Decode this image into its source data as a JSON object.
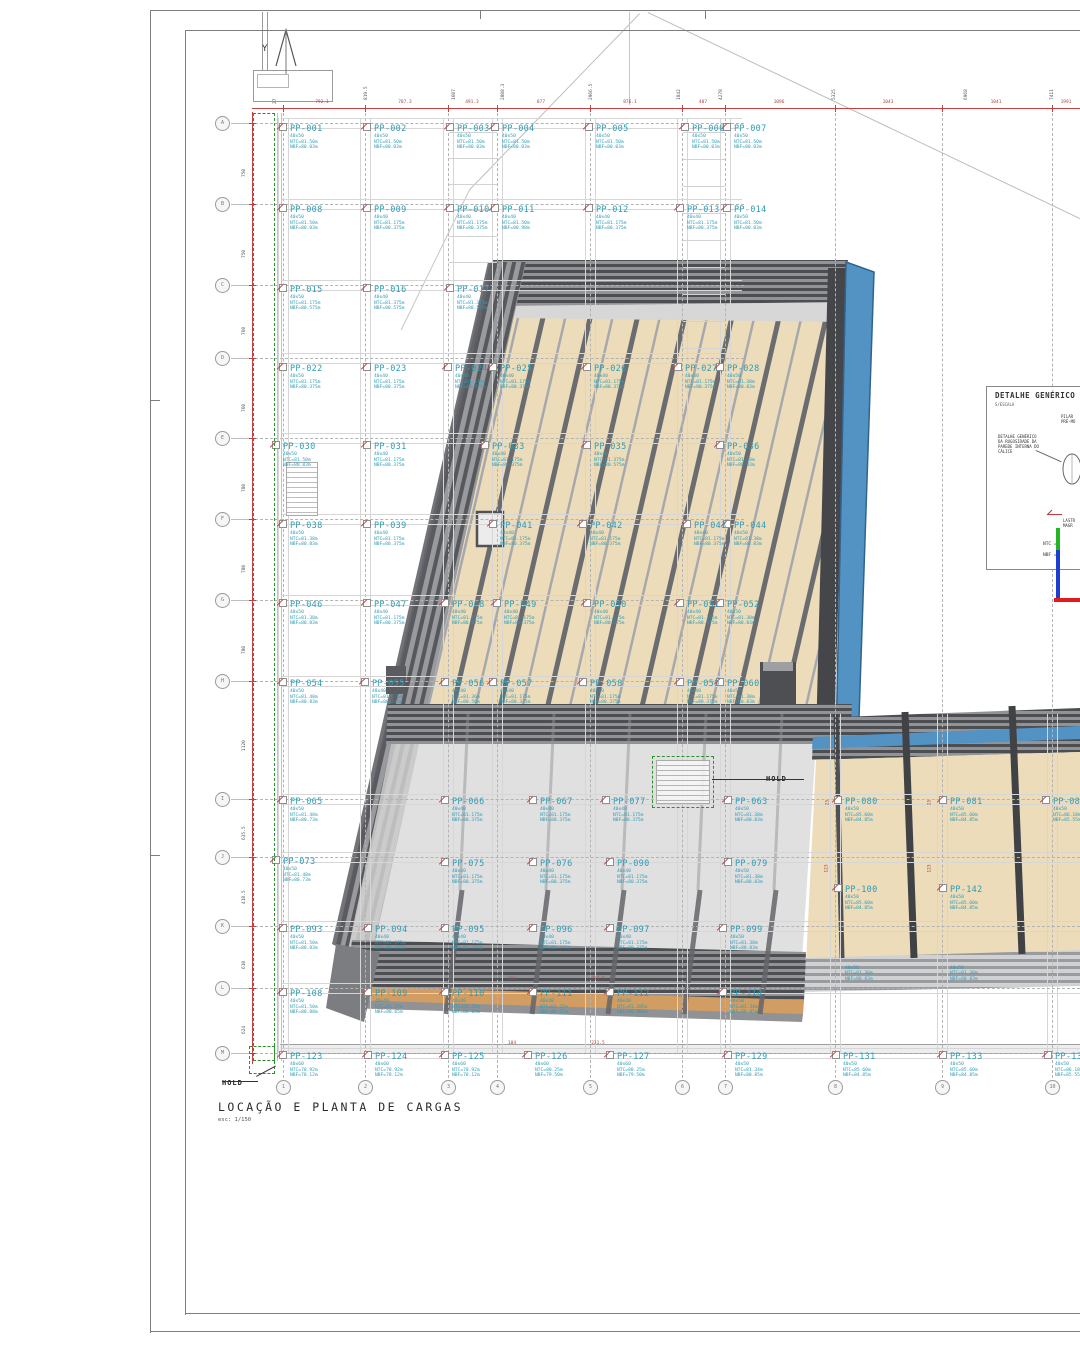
{
  "sheet": {
    "north_label": "Y",
    "title": "LOCAÇÃO E PLANTA DE CARGAS",
    "scale_note": "esc: 1/150",
    "hold_label": "HOLD"
  },
  "detail_box": {
    "title": "DETALHE GENÉRICO",
    "scale": "S/ESCALA",
    "pilar_label": "PILAR\nPRÉ-MO",
    "rugosidade_label": "DETALHE GENÉRICO\nDA RUGOSIDADE DA\nPAREDE INTERNA DO\nCÁLICE",
    "lastro_label": "LASTR\nMAGR",
    "ntc_label": "NTC =",
    "nbf_label": "NBF ="
  },
  "colors": {
    "pile_label": "#2e9bb5",
    "dimension_red": "#c24040",
    "hold_green": "#2f8f2f",
    "blue_cladding": "#4b8fc2",
    "floor_beige": "#ecdbb8",
    "wood_band": "#d09a5c"
  },
  "grid": {
    "rows": [
      {
        "label": "A",
        "y": 123
      },
      {
        "label": "B",
        "y": 204
      },
      {
        "label": "C",
        "y": 285
      },
      {
        "label": "D",
        "y": 358
      },
      {
        "label": "E",
        "y": 438
      },
      {
        "label": "F",
        "y": 519
      },
      {
        "label": "G",
        "y": 600
      },
      {
        "label": "H",
        "y": 681
      },
      {
        "label": "I",
        "y": 799
      },
      {
        "label": "J",
        "y": 857
      },
      {
        "label": "K",
        "y": 926
      },
      {
        "label": "L",
        "y": 988
      },
      {
        "label": "M",
        "y": 1053
      }
    ],
    "cols": [
      {
        "label": "1",
        "x": 283
      },
      {
        "label": "2",
        "x": 365
      },
      {
        "label": "3",
        "x": 448
      },
      {
        "label": "4",
        "x": 497
      },
      {
        "label": "5",
        "x": 590
      },
      {
        "label": "6",
        "x": 682
      },
      {
        "label": "7",
        "x": 725
      },
      {
        "label": "8",
        "x": 835
      },
      {
        "label": "9",
        "x": 942
      },
      {
        "label": "10",
        "x": 1052
      }
    ]
  },
  "dims": {
    "top_values": [
      {
        "t": "792.1",
        "x": 322
      },
      {
        "t": "787.3",
        "x": 405
      },
      {
        "t": "491.3",
        "x": 472
      },
      {
        "t": "877",
        "x": 541
      },
      {
        "t": "876.1",
        "x": 630
      },
      {
        "t": "407",
        "x": 703
      },
      {
        "t": "1096",
        "x": 779
      },
      {
        "t": "1043",
        "x": 888
      },
      {
        "t": "1041",
        "x": 996
      },
      {
        "t": "1991",
        "x": 1066
      }
    ],
    "top_rotated": [
      {
        "t": "819.5",
        "x": 367
      },
      {
        "t": "1607",
        "x": 455
      },
      {
        "t": "2808.3",
        "x": 504
      },
      {
        "t": "2966.5",
        "x": 592
      },
      {
        "t": "1842",
        "x": 680
      },
      {
        "t": "4278",
        "x": 722
      },
      {
        "t": "5325",
        "x": 835
      },
      {
        "t": "6968",
        "x": 967
      },
      {
        "t": "7411",
        "x": 1053
      }
    ],
    "left_rotated": [
      {
        "t": "750",
        "y": 163
      },
      {
        "t": "750",
        "y": 244
      },
      {
        "t": "760",
        "y": 321
      },
      {
        "t": "760",
        "y": 398
      },
      {
        "t": "780",
        "y": 478
      },
      {
        "t": "780",
        "y": 559
      },
      {
        "t": "780",
        "y": 640
      },
      {
        "t": "1120",
        "y": 737
      },
      {
        "t": "635.5",
        "y": 826
      },
      {
        "t": "418.5",
        "y": 890
      },
      {
        "t": "610",
        "y": 955
      },
      {
        "t": "624",
        "y": 1020
      }
    ],
    "inner": [
      {
        "t": "104",
        "x": 512,
        "y": 977
      },
      {
        "t": "231.5",
        "x": 598,
        "y": 977
      },
      {
        "t": "104",
        "x": 512,
        "y": 1041
      },
      {
        "t": "231.5",
        "x": 598,
        "y": 1041
      },
      {
        "t": "25",
        "x": 828,
        "y": 800,
        "rot": true
      },
      {
        "t": "123",
        "x": 827,
        "y": 866,
        "rot": true
      },
      {
        "t": "25",
        "x": 930,
        "y": 800,
        "rot": true
      },
      {
        "t": "123",
        "x": 930,
        "y": 866,
        "rot": true
      }
    ],
    "misc_rotated": [
      {
        "t": "27",
        "x": 273,
        "y": 80
      }
    ]
  },
  "piles": [
    {
      "id": "PP-001",
      "x": 290,
      "y": 125,
      "s": [
        "40x50",
        "NTC=81.50m",
        "NBF=80.03m"
      ]
    },
    {
      "id": "PP-002",
      "x": 374,
      "y": 125,
      "s": [
        "40x50",
        "NTC=81.50m",
        "NBF=80.03m"
      ]
    },
    {
      "id": "PP-003",
      "x": 457,
      "y": 125,
      "s": [
        "40x50",
        "NTC=81.50m",
        "NBF=80.03m"
      ]
    },
    {
      "id": "PP-004",
      "x": 502,
      "y": 125,
      "s": [
        "40x50",
        "NTC=81.50m",
        "NBF=80.03m"
      ]
    },
    {
      "id": "PP-005",
      "x": 596,
      "y": 125,
      "s": [
        "40x50",
        "NTC=81.50m",
        "NBF=80.03m"
      ]
    },
    {
      "id": "PP-006",
      "x": 692,
      "y": 125,
      "s": [
        "40x50",
        "NTC=81.50m",
        "NBF=80.03m"
      ]
    },
    {
      "id": "PP-007",
      "x": 734,
      "y": 125,
      "s": [
        "40x50",
        "NTC=81.50m",
        "NBF=80.03m"
      ]
    },
    {
      "id": "PP-008",
      "x": 290,
      "y": 206,
      "s": [
        "40x50",
        "NTC=81.50m",
        "NBF=80.03m"
      ]
    },
    {
      "id": "PP-009",
      "x": 374,
      "y": 206,
      "s": [
        "40x40",
        "NTC=81.175m",
        "NBF=80.375m"
      ]
    },
    {
      "id": "PP-010",
      "x": 457,
      "y": 206,
      "s": [
        "40x40",
        "NTC=81.175m",
        "NBF=80.375m"
      ]
    },
    {
      "id": "PP-011",
      "x": 502,
      "y": 206,
      "s": [
        "40x40",
        "NTC=81.50m",
        "NBF=80.98m"
      ]
    },
    {
      "id": "PP-012",
      "x": 596,
      "y": 206,
      "s": [
        "40x40",
        "NTC=81.175m",
        "NBF=80.375m"
      ]
    },
    {
      "id": "PP-013",
      "x": 687,
      "y": 206,
      "s": [
        "40x40",
        "NTC=81.175m",
        "NBF=80.375m"
      ]
    },
    {
      "id": "PP-014",
      "x": 734,
      "y": 206,
      "s": [
        "40x50",
        "NTC=81.50m",
        "NBF=80.03m"
      ]
    },
    {
      "id": "PP-015",
      "x": 290,
      "y": 286,
      "s": [
        "40x50",
        "NTC=81.175m",
        "NBF=80.575m"
      ]
    },
    {
      "id": "PP-016",
      "x": 374,
      "y": 286,
      "s": [
        "40x40",
        "NTC=81.375m",
        "NBF=80.575m"
      ]
    },
    {
      "id": "PP-017",
      "x": 457,
      "y": 286,
      "s": [
        "40x40",
        "NTC=81.375m",
        "NBF=80.575m"
      ]
    },
    {
      "id": "PP-022",
      "x": 290,
      "y": 365,
      "s": [
        "40x50",
        "NTC=81.175m",
        "NBF=80.375m"
      ]
    },
    {
      "id": "PP-023",
      "x": 374,
      "y": 365,
      "s": [
        "40x40",
        "NTC=81.175m",
        "NBF=80.375m"
      ]
    },
    {
      "id": "PP-024",
      "x": 455,
      "y": 365,
      "s": [
        "40x40",
        "NTC=81.175m",
        "NBF=80.375m"
      ]
    },
    {
      "id": "PP-025",
      "x": 500,
      "y": 365,
      "s": [
        "40x40",
        "NTC=81.175m",
        "NBF=80.375m"
      ]
    },
    {
      "id": "PP-026",
      "x": 594,
      "y": 365,
      "s": [
        "40x40",
        "NTC=81.175m",
        "NBF=80.375m"
      ]
    },
    {
      "id": "PP-027",
      "x": 685,
      "y": 365,
      "s": [
        "40x40",
        "NTC=81.175m",
        "NBF=80.375m"
      ]
    },
    {
      "id": "PP-028",
      "x": 727,
      "y": 365,
      "s": [
        "40x50",
        "NTC=81.38m",
        "NBF=80.83m"
      ]
    },
    {
      "id": "PP-030",
      "x": 283,
      "y": 443,
      "s": [
        "40x50",
        "NTC=81.50m",
        "NBF=80.83m"
      ]
    },
    {
      "id": "PP-031",
      "x": 374,
      "y": 443,
      "s": [
        "40x40",
        "NTC=81.175m",
        "NBF=80.375m"
      ]
    },
    {
      "id": "PP-033",
      "x": 492,
      "y": 443,
      "s": [
        "40x40",
        "NTC=81.175m",
        "NBF=80.375m"
      ]
    },
    {
      "id": "PP-035",
      "x": 594,
      "y": 443,
      "s": [
        "40x40",
        "NTC=81.375m",
        "NBF=80.575m"
      ]
    },
    {
      "id": "PP-036",
      "x": 727,
      "y": 443,
      "s": [
        "40x50",
        "NTC=81.38m",
        "NBF=80.83m"
      ]
    },
    {
      "id": "PP-038",
      "x": 290,
      "y": 522,
      "s": [
        "40x50",
        "NTC=81.38m",
        "NBF=80.83m"
      ]
    },
    {
      "id": "PP-039",
      "x": 374,
      "y": 522,
      "s": [
        "40x40",
        "NTC=81.175m",
        "NBF=80.375m"
      ]
    },
    {
      "id": "PP-041",
      "x": 500,
      "y": 522,
      "s": [
        "40x40",
        "NTC=81.175m",
        "NBF=80.375m"
      ]
    },
    {
      "id": "PP-042",
      "x": 590,
      "y": 522,
      "s": [
        "40x40",
        "NTC=81.175m",
        "NBF=80.375m"
      ]
    },
    {
      "id": "PP-043",
      "x": 694,
      "y": 522,
      "s": [
        "40x40",
        "NTC=81.175m",
        "NBF=80.375m"
      ]
    },
    {
      "id": "PP-044",
      "x": 734,
      "y": 522,
      "s": [
        "40x50",
        "NTC=81.38m",
        "NBF=80.83m"
      ]
    },
    {
      "id": "PP-046",
      "x": 290,
      "y": 601,
      "s": [
        "40x50",
        "NTC=81.38m",
        "NBF=80.83m"
      ]
    },
    {
      "id": "PP-047",
      "x": 374,
      "y": 601,
      "s": [
        "40x40",
        "NTC=81.175m",
        "NBF=80.375m"
      ]
    },
    {
      "id": "PP-048",
      "x": 452,
      "y": 601,
      "s": [
        "40x40",
        "NTC=81.175m",
        "NBF=80.375m"
      ]
    },
    {
      "id": "PP-049",
      "x": 504,
      "y": 601,
      "s": [
        "40x40",
        "NTC=81.175m",
        "NBF=80.375m"
      ]
    },
    {
      "id": "PP-050",
      "x": 594,
      "y": 601,
      "s": [
        "40x40",
        "NTC=81.175m",
        "NBF=80.375m"
      ]
    },
    {
      "id": "PP-051",
      "x": 687,
      "y": 601,
      "s": [
        "40x40",
        "NTC=81.175m",
        "NBF=80.375m"
      ]
    },
    {
      "id": "PP-052",
      "x": 727,
      "y": 601,
      "s": [
        "40x50",
        "NTC=81.38m",
        "NBF=80.83m"
      ]
    },
    {
      "id": "PP-054",
      "x": 290,
      "y": 680,
      "s": [
        "40x50",
        "NTC=81.40m",
        "NBF=80.83m"
      ]
    },
    {
      "id": "PP-055",
      "x": 372,
      "y": 680,
      "s": [
        "40x40",
        "NTC=81.175m",
        "NBF=80.375m"
      ]
    },
    {
      "id": "PP-056",
      "x": 452,
      "y": 680,
      "s": [
        "40x40",
        "NTC=81.36m",
        "NBF=80.56m"
      ]
    },
    {
      "id": "PP-057",
      "x": 500,
      "y": 680,
      "s": [
        "40x40",
        "NTC=81.175m",
        "NBF=80.375m"
      ]
    },
    {
      "id": "PP-058",
      "x": 590,
      "y": 680,
      "s": [
        "40x40",
        "NTC=81.175m",
        "NBF=80.375m"
      ]
    },
    {
      "id": "PP-059",
      "x": 687,
      "y": 680,
      "s": [
        "40x40",
        "NTC=81.175m",
        "NBF=80.375m"
      ]
    },
    {
      "id": "PP-060",
      "x": 727,
      "y": 680,
      "s": [
        "40x50",
        "NTC=81.38m",
        "NBF=80.83m"
      ]
    },
    {
      "id": "PP-065",
      "x": 290,
      "y": 798,
      "s": [
        "40x50",
        "NTC=81.48m",
        "NBF=80.73m"
      ]
    },
    {
      "id": "PP-066",
      "x": 452,
      "y": 798,
      "s": [
        "40x40",
        "NTC=81.175m",
        "NBF=80.375m"
      ]
    },
    {
      "id": "PP-067",
      "x": 540,
      "y": 798,
      "s": [
        "40x40",
        "NTC=81.175m",
        "NBF=80.375m"
      ]
    },
    {
      "id": "PP-077",
      "x": 613,
      "y": 798,
      "s": [
        "40x40",
        "NTC=81.175m",
        "NBF=80.375m"
      ]
    },
    {
      "id": "PP-063",
      "x": 735,
      "y": 798,
      "s": [
        "40x50",
        "NTC=81.38m",
        "NBF=80.83m"
      ]
    },
    {
      "id": "PP-080",
      "x": 845,
      "y": 798,
      "s": [
        "40x50",
        "NTC=85.60m",
        "NBF=84.85m"
      ]
    },
    {
      "id": "PP-081",
      "x": 950,
      "y": 798,
      "s": [
        "40x50",
        "NTC=85.60m",
        "NBF=84.85m"
      ]
    },
    {
      "id": "PP-082",
      "x": 1053,
      "y": 798,
      "s": [
        "40x50",
        "NTC=86.18m",
        "NBF=85.55m"
      ]
    },
    {
      "id": "PP-073",
      "x": 283,
      "y": 858,
      "s": [
        "40x50",
        "NTC=81.48m",
        "NBF=80.73m"
      ]
    },
    {
      "id": "PP-075",
      "x": 452,
      "y": 860,
      "s": [
        "40x40",
        "NTC=81.175m",
        "NBF=80.375m"
      ]
    },
    {
      "id": "PP-076",
      "x": 540,
      "y": 860,
      "s": [
        "40x40",
        "NTC=81.175m",
        "NBF=80.375m"
      ]
    },
    {
      "id": "PP-090",
      "x": 617,
      "y": 860,
      "s": [
        "40x40",
        "NTC=81.175m",
        "NBF=80.375m"
      ]
    },
    {
      "id": "PP-079",
      "x": 735,
      "y": 860,
      "s": [
        "40x50",
        "NTC=81.38m",
        "NBF=80.83m"
      ]
    },
    {
      "id": "PP-100",
      "x": 845,
      "y": 886,
      "s": [
        "40x50",
        "NTC=85.60m",
        "NBF=84.85m"
      ]
    },
    {
      "id": "PP-142",
      "x": 950,
      "y": 886,
      "s": [
        "40x50",
        "NTC=85.60m",
        "NBF=84.85m"
      ]
    },
    {
      "id": "PP-093",
      "x": 290,
      "y": 926,
      "s": [
        "40x50",
        "NTC=81.50m",
        "NBF=80.83m"
      ]
    },
    {
      "id": "PP-094",
      "x": 375,
      "y": 926,
      "s": [
        "40x40",
        "NTC=81.175m",
        "NBF=80.375m"
      ]
    },
    {
      "id": "PP-095",
      "x": 452,
      "y": 926,
      "s": [
        "40x40",
        "NTC=81.175m",
        "NBF=80.375m"
      ]
    },
    {
      "id": "PP-096",
      "x": 540,
      "y": 926,
      "s": [
        "40x40",
        "NTC=81.175m",
        "NBF=80.375m"
      ]
    },
    {
      "id": "PP-097",
      "x": 617,
      "y": 926,
      "s": [
        "40x40",
        "NTC=81.175m",
        "NBF=80.375m"
      ]
    },
    {
      "id": "PP-099",
      "x": 730,
      "y": 926,
      "s": [
        "40x50",
        "NTC=81.38m",
        "NBF=80.83m"
      ]
    },
    {
      "id": "PP-108",
      "x": 290,
      "y": 990,
      "s": [
        "40x50",
        "NTC=81.50m",
        "NBF=80.88m"
      ]
    },
    {
      "id": "PP-109",
      "x": 375,
      "y": 990,
      "s": [
        "40x40",
        "NTC=81.25m",
        "NBF=80.65m"
      ]
    },
    {
      "id": "PP-110",
      "x": 452,
      "y": 990,
      "s": [
        "40x40",
        "NTC=81.25m",
        "NBF=80.65m"
      ]
    },
    {
      "id": "PP-111",
      "x": 540,
      "y": 990,
      "s": [
        "40x40",
        "NTC=81.25m",
        "NBF=80.65m"
      ]
    },
    {
      "id": "PP-112",
      "x": 617,
      "y": 990,
      "s": [
        "40x40",
        "NTC=81.285m",
        "NBF=80.605m"
      ]
    },
    {
      "id": "PP-114",
      "x": 730,
      "y": 990,
      "s": [
        "40x50",
        "NTC=81.34m",
        "NBF=80.85m"
      ]
    },
    {
      "id": "",
      "x": 845,
      "y": 966,
      "s": [
        "40x50",
        "NTC=81.30m",
        "NBF=80.83m"
      ]
    },
    {
      "id": "",
      "x": 950,
      "y": 966,
      "s": [
        "40x50",
        "NTC=81.30m",
        "NBF=80.83m"
      ]
    },
    {
      "id": "PP-123",
      "x": 290,
      "y": 1053,
      "s": [
        "40x60",
        "NTC=78.92m",
        "NBF=78.12m"
      ]
    },
    {
      "id": "PP-124",
      "x": 375,
      "y": 1053,
      "s": [
        "40x60",
        "NTC=78.92m",
        "NBF=78.12m"
      ]
    },
    {
      "id": "PP-125",
      "x": 452,
      "y": 1053,
      "s": [
        "40x60",
        "NTC=78.92m",
        "NBF=78.12m"
      ]
    },
    {
      "id": "PP-126",
      "x": 535,
      "y": 1053,
      "s": [
        "40x60",
        "NTC=80.25m",
        "NBF=79.50m"
      ]
    },
    {
      "id": "PP-127",
      "x": 617,
      "y": 1053,
      "s": [
        "40x60",
        "NTC=80.25m",
        "NBF=79.50m"
      ]
    },
    {
      "id": "PP-129",
      "x": 735,
      "y": 1053,
      "s": [
        "40x50",
        "NTC=81.34m",
        "NBF=80.85m"
      ]
    },
    {
      "id": "PP-131",
      "x": 843,
      "y": 1053,
      "s": [
        "40x50",
        "NTC=85.60m",
        "NBF=84.85m"
      ]
    },
    {
      "id": "PP-133",
      "x": 950,
      "y": 1053,
      "s": [
        "40x50",
        "NTC=85.60m",
        "NBF=84.85m"
      ]
    },
    {
      "id": "PP-135",
      "x": 1055,
      "y": 1053,
      "s": [
        "40x50",
        "NTC=86.18m",
        "NBF=85.55m"
      ]
    }
  ]
}
